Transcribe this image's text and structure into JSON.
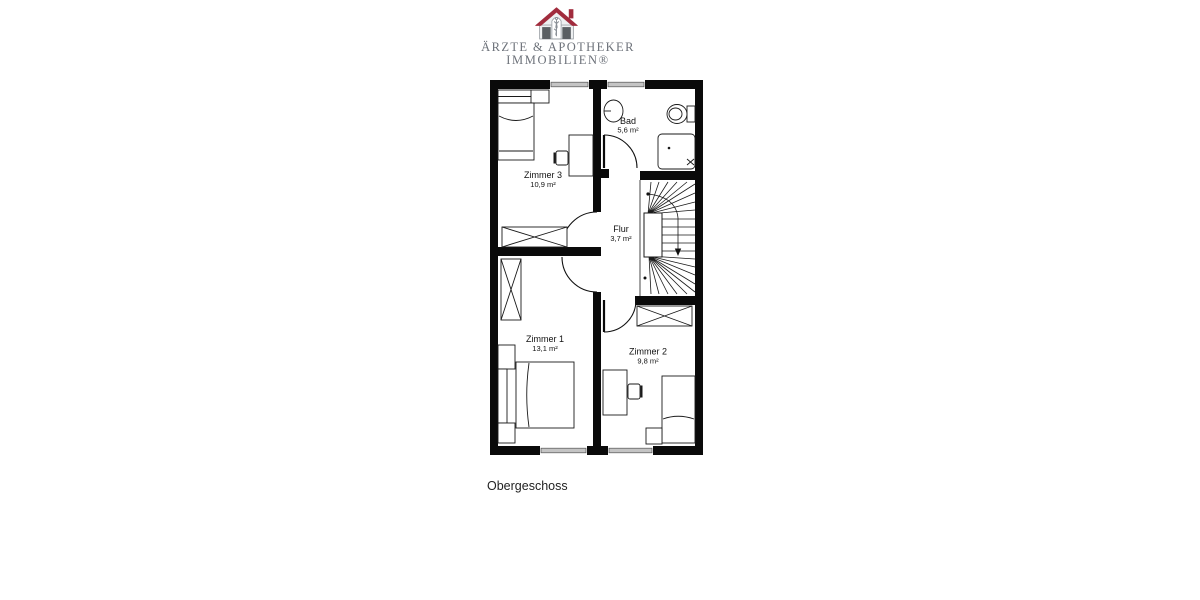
{
  "brand": {
    "line1": "ÄRZTE & APOTHEKER",
    "line2": "IMMOBILIEN®",
    "icon": "house-caduceus-icon",
    "colors": {
      "roof": "#a12c3d",
      "window": "#5a5f63",
      "outline": "#9aa0a5",
      "text": "#6d727a"
    }
  },
  "plan": {
    "floor_label": "Obergeschoss",
    "rooms": [
      {
        "id": "zimmer3",
        "name": "Zimmer 3",
        "area": "10,9 m²"
      },
      {
        "id": "bad",
        "name": "Bad",
        "area": "5,6 m²"
      },
      {
        "id": "flur",
        "name": "Flur",
        "area": "3,7 m²"
      },
      {
        "id": "zimmer1",
        "name": "Zimmer 1",
        "area": "13,1 m²"
      },
      {
        "id": "zimmer2",
        "name": "Zimmer 2",
        "area": "9,8 m²"
      }
    ],
    "colors": {
      "wall": "#0a0a0a",
      "line": "#1a1a1a",
      "window_glass": "#c4c4c4"
    }
  }
}
